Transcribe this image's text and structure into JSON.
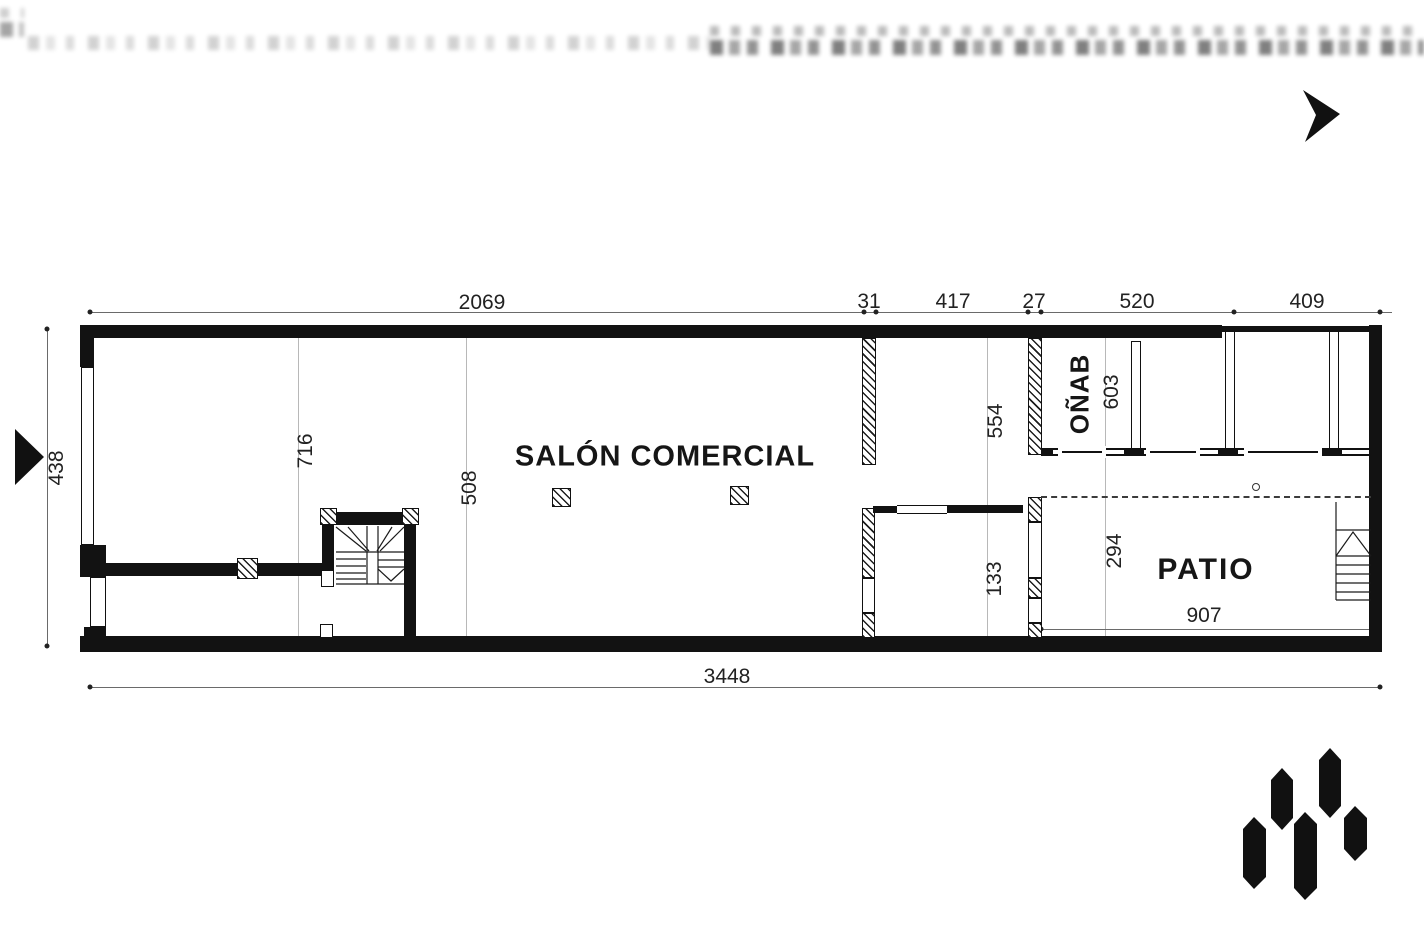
{
  "drawing": {
    "title": "commercial premises floor plan",
    "rooms": {
      "salon": "SALÓN COMERCIAL",
      "bano": "BAÑO",
      "patio": "PATIO"
    },
    "dimensions": {
      "top_row": [
        "2069",
        "31",
        "417",
        "27",
        "520",
        "409"
      ],
      "left": "834",
      "bottom": "3448",
      "patio_width": "907",
      "interior": {
        "salon_grid_a": "617",
        "salon_grid_b": "805",
        "corridor": "455",
        "vestibule": "331",
        "bano_width": "306",
        "patio_depth": "492"
      }
    },
    "icons": {
      "north_arrow": "north-arrow-icon",
      "entry_arrow": "entry-arrow-icon",
      "brand_logo": "brand-logo"
    },
    "watermark": "illegible blurred text band"
  },
  "colors": {
    "ink": "#121212",
    "dim": "#222222",
    "grid": "#b8b8b8",
    "background": "#ffffff"
  }
}
